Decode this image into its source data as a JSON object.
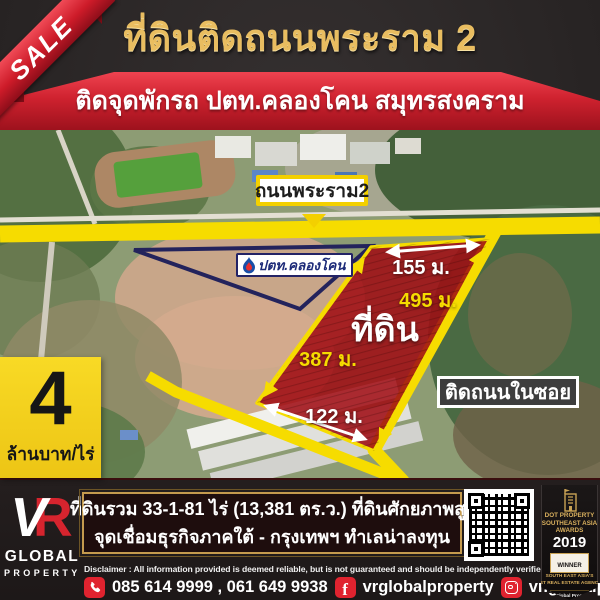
{
  "colors": {
    "accent_red": "#cf222f",
    "gold_text": "#e9bd60",
    "road_yellow": "#f6dc00",
    "plot_red": "#a00d13",
    "price_yellow": "#f6d41e",
    "award_gold": "#d9b05e"
  },
  "ribbon": {
    "label": "SALE"
  },
  "header": {
    "title": "ที่ดินติดถนนพระราม 2",
    "subtitle": "ติดจุดพักรถ ปตท.คลองโคน สมุทรสงคราม"
  },
  "map": {
    "road_label": "ถนนพระราม2",
    "station_label": "ปตท.คลองโคน",
    "plot_label": "ที่ดิน",
    "dims": {
      "top": "155 ม.",
      "right": "495 ม.",
      "left": "387 ม.",
      "bottom": "122 ม."
    },
    "soi_label": "ติดถนนในซอย"
  },
  "price": {
    "number": "4",
    "unit": "ล้านบาท/ไร่"
  },
  "logo": {
    "letter_v": "V",
    "letter_r": "R",
    "word1": "GLOBAL",
    "word2": "PROPERTY"
  },
  "info": {
    "line1": "ที่ดินรวม 33-1-81 ไร่ (13,381 ตร.ว.) ที่ดินศักยภาพสูง",
    "line2": "จุดเชื่อมธุรกิจภาคใต้ - กรุงเทพฯ  ทำเลน่าลงทุน"
  },
  "disclaimer": "Disclaimer :  All information provided is deemed reliable, but is not guaranteed and should be independently verified.",
  "contact": {
    "phone": "085 614 9999 , 061 649 9938",
    "facebook": "vrglobalproperty",
    "instagram": "vr.globalproperty"
  },
  "award": {
    "brand1": "DOT PROPERTY",
    "brand2": "SOUTHEAST ASIA",
    "brand3": "AWARDS",
    "year": "2019",
    "winner": "WINNER",
    "sub1": "SOUTH EAST ASIA'S",
    "sub2": "BEST REAL ESTATE AGENCIES",
    "sub3": "VR Global Property"
  }
}
